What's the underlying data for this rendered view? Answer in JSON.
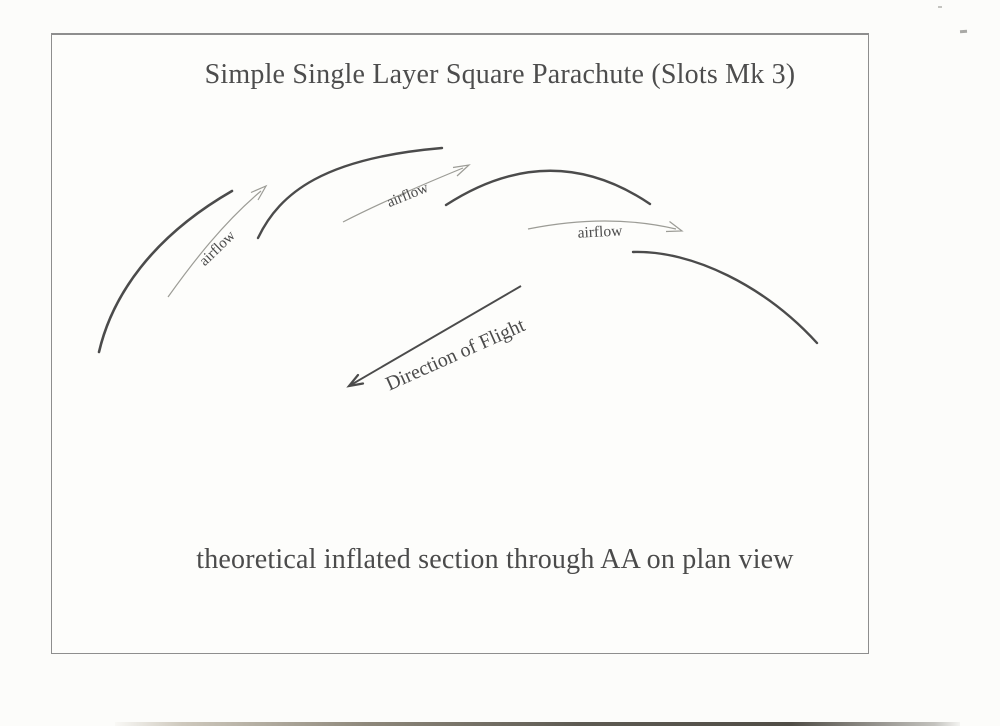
{
  "page": {
    "title": "Simple Single Layer Square Parachute (Slots Mk 3)",
    "caption": "theoretical inflated section through AA on plan view"
  },
  "diagram": {
    "airflow_labels": [
      "airflow",
      "airflow",
      "airflow"
    ],
    "flight_label": "Direction of Flight",
    "canopy_sections": 4
  },
  "colors": {
    "ink": "#4b4b4b",
    "thin_arrow": "#9c9c96",
    "border": "#8e8e8e",
    "paper": "#fcfcfa"
  }
}
